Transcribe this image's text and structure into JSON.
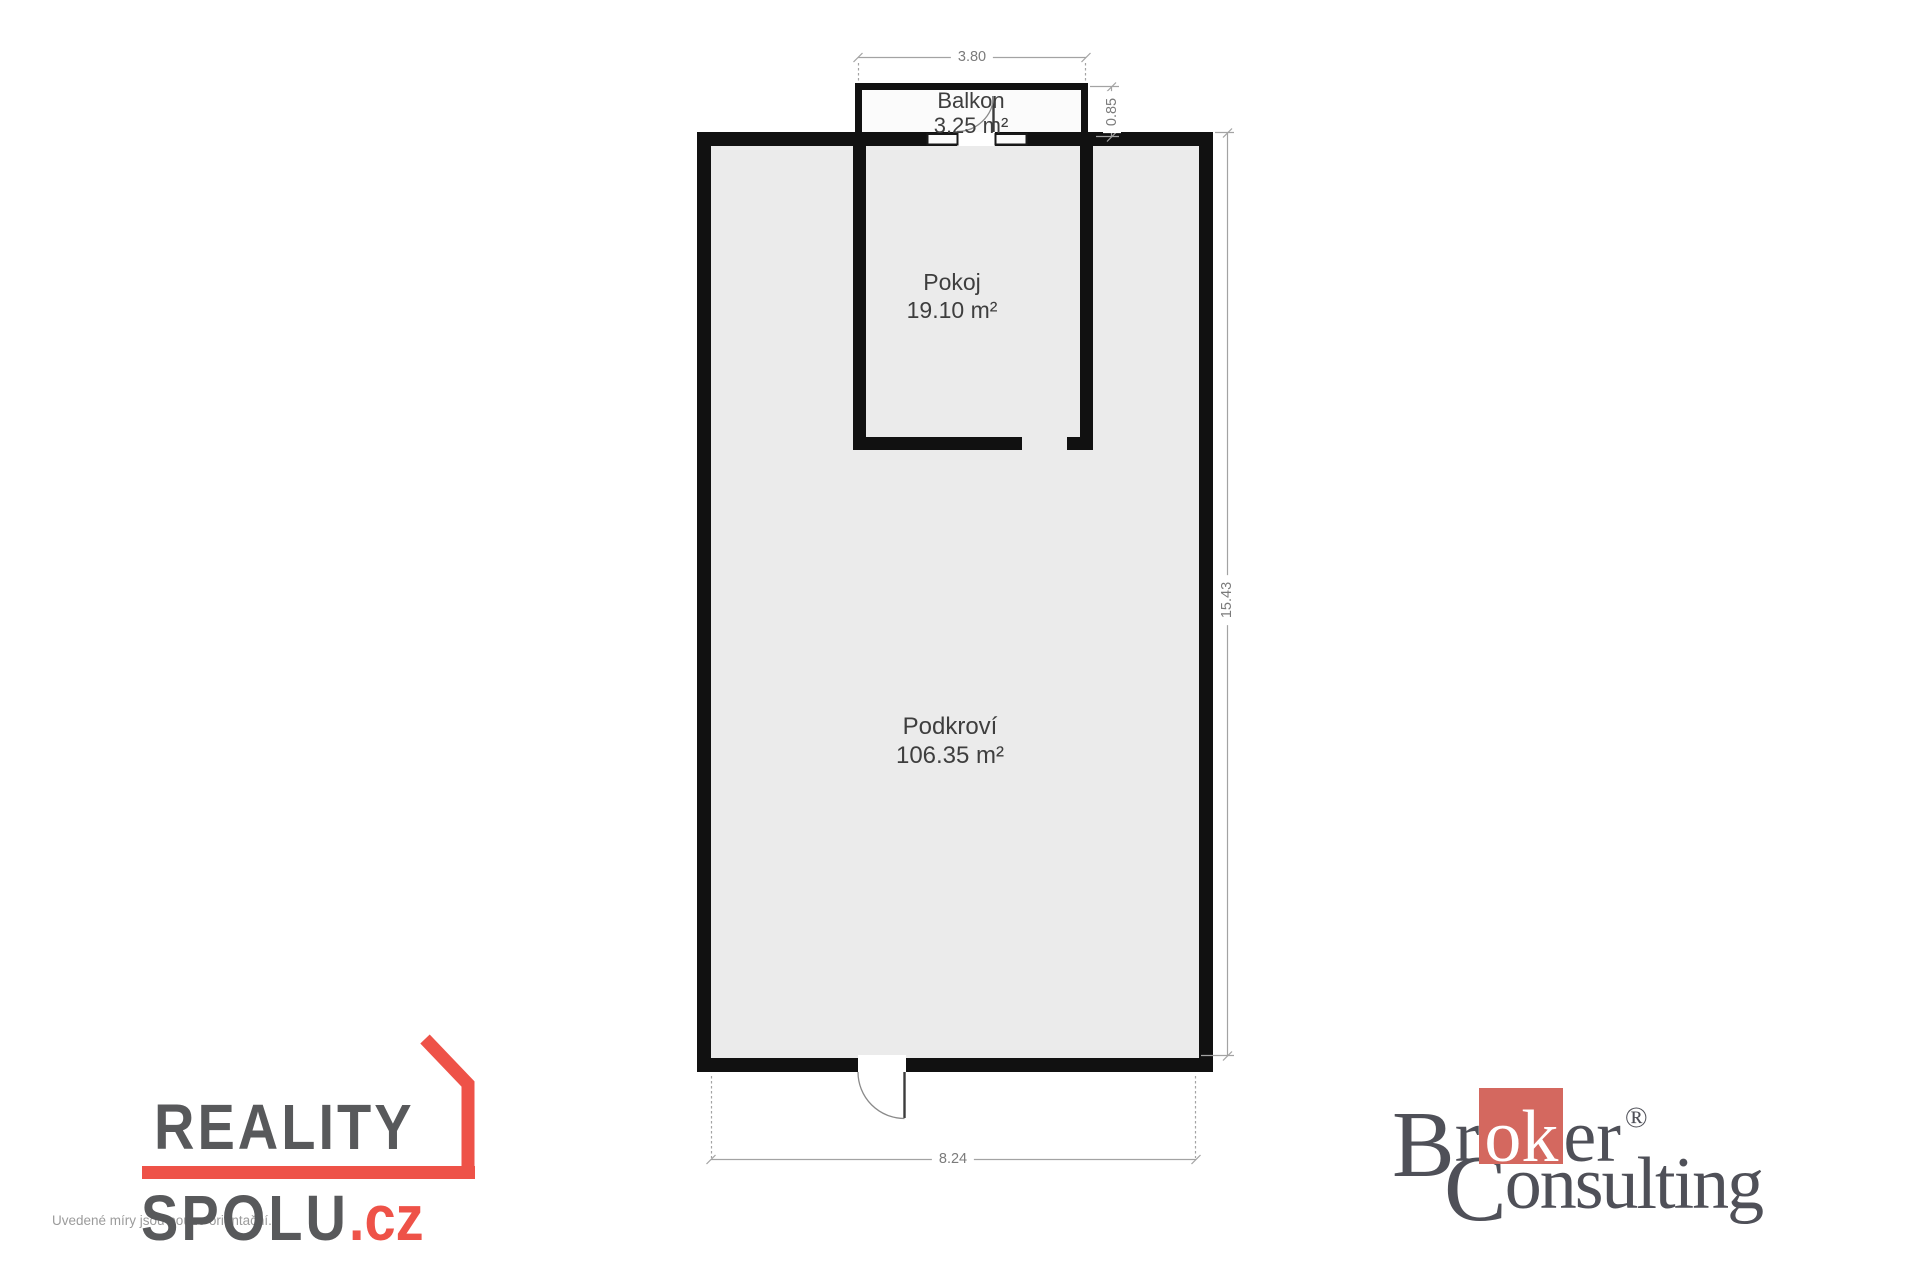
{
  "plan": {
    "rooms": {
      "balkon": {
        "name": "Balkon",
        "area": "3.25 m²"
      },
      "pokoj": {
        "name": "Pokoj",
        "area": "19.10 m²"
      },
      "podkrovi": {
        "name": "Podkroví",
        "area": "106.35 m²"
      }
    },
    "dimensions": {
      "balkon_width": "3.80",
      "balkon_depth": "0.85",
      "building_height": "15.43",
      "building_width": "8.24"
    }
  },
  "branding": {
    "disclaimer": "Uvedené míry jsou pouze orientační.",
    "reality_spolu": {
      "word1": "REALITY",
      "word2": "SPOLU",
      "suffix": ".cz"
    },
    "broker_consulting": {
      "b_initial": "B",
      "part1": "r",
      "part2": "ok",
      "part3": "er",
      "registered": "®",
      "c_initial": "C",
      "part4": "onsulting"
    }
  },
  "colors": {
    "wall": "#111111",
    "floor": "#ebebeb",
    "reality_red": "#ee5248",
    "reality_gray": "#58595b",
    "broker_red": "#d4685f",
    "broker_gray": "#4f5058"
  }
}
